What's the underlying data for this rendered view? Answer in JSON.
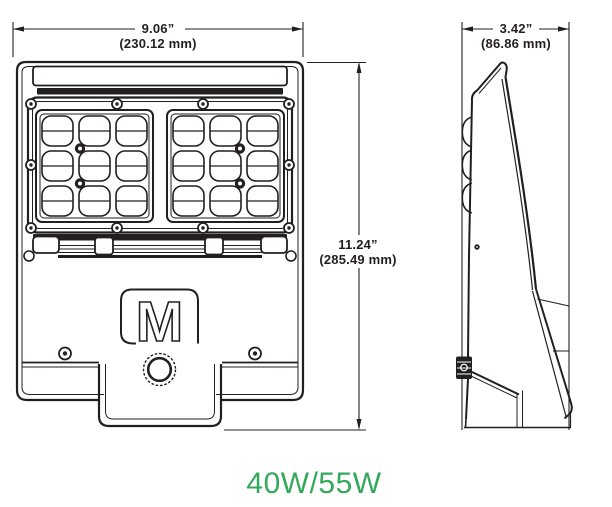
{
  "figure": {
    "type": "technical dimension drawing",
    "subject": "LED flood light luminaire, front and side views",
    "views": [
      "front",
      "side"
    ],
    "led_modules": 2,
    "lenses_per_module": 9
  },
  "dimensions": {
    "width": {
      "inches": "9.06”",
      "mm": "(230.12 mm)"
    },
    "depth": {
      "inches": "3.42”",
      "mm": "(86.86 mm)"
    },
    "height": {
      "inches": "11.24”",
      "mm": "(285.49 mm)"
    }
  },
  "wattage": {
    "label": "40W/55W"
  },
  "logo": {
    "letter": "M"
  },
  "colors": {
    "line": "#231f20",
    "background": "#ffffff",
    "wattage_green": "#34a85c"
  }
}
